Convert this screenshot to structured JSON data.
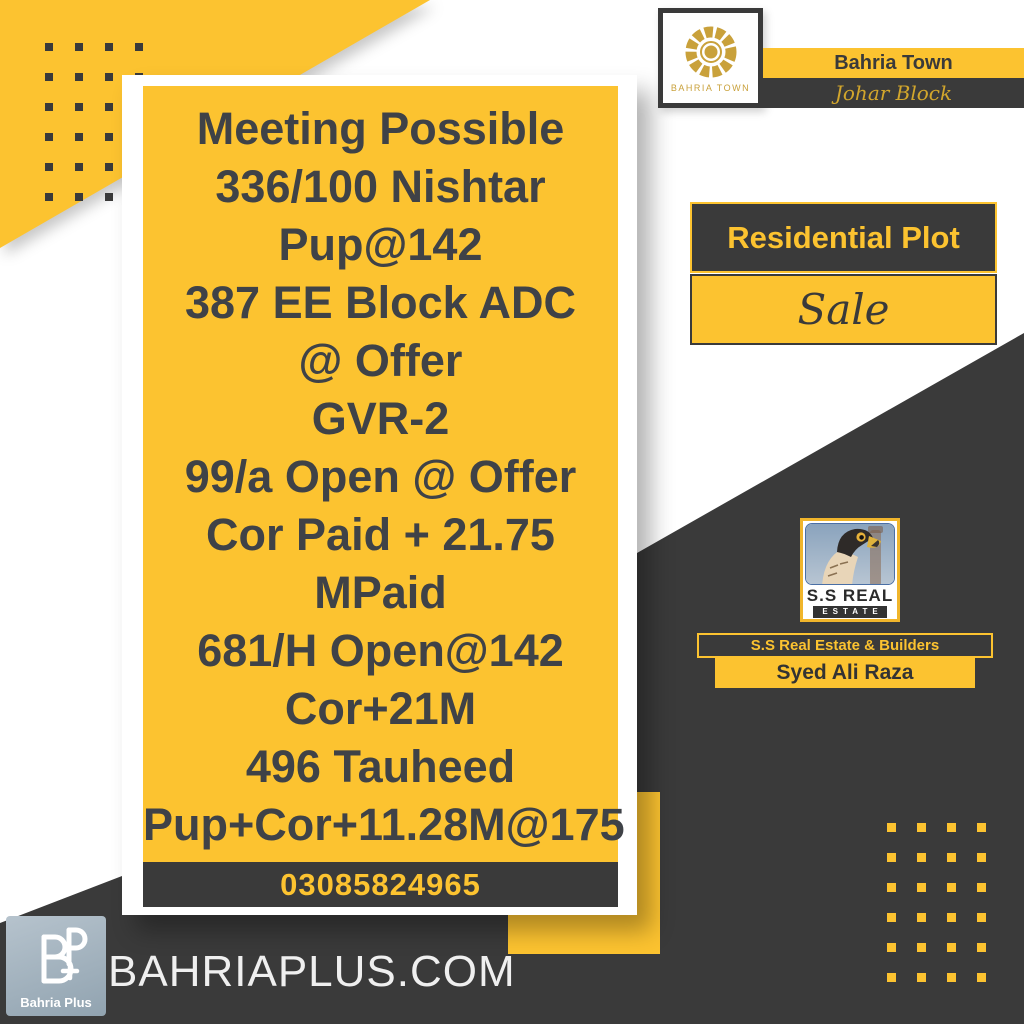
{
  "poster": {
    "bahria_town": {
      "logo_caption": "BAHRIA TOWN",
      "name": "Bahria Town",
      "block": "Johar Block"
    },
    "offer": {
      "category": "Residential Plot",
      "mode": "Sale"
    },
    "listing": {
      "lines": [
        "Meeting Possible",
        "336/100 Nishtar",
        "Pup@142",
        "387 EE Block ADC",
        "@ Offer",
        "GVR-2",
        "99/a Open @ Offer",
        "Cor Paid + 21.75",
        "MPaid",
        "681/H Open@142",
        "Cor+21M",
        "496 Tauheed",
        "Pup+Cor+11.28M@175"
      ],
      "phone": "03085824965"
    },
    "agency": {
      "logo_title": "S.S REAL",
      "logo_subtitle": "ESTATE",
      "name": "S.S Real Estate & Builders",
      "agent": "Syed Ali Raza"
    },
    "footer": {
      "brand": "Bahria Plus",
      "website": "BAHRIAPLUS.COM"
    },
    "colors": {
      "yellow": "#fcc330",
      "dark": "#3a3a3a",
      "gold": "#c9a13b",
      "listing_text": "#3f4247",
      "background": "#ffffff"
    }
  }
}
